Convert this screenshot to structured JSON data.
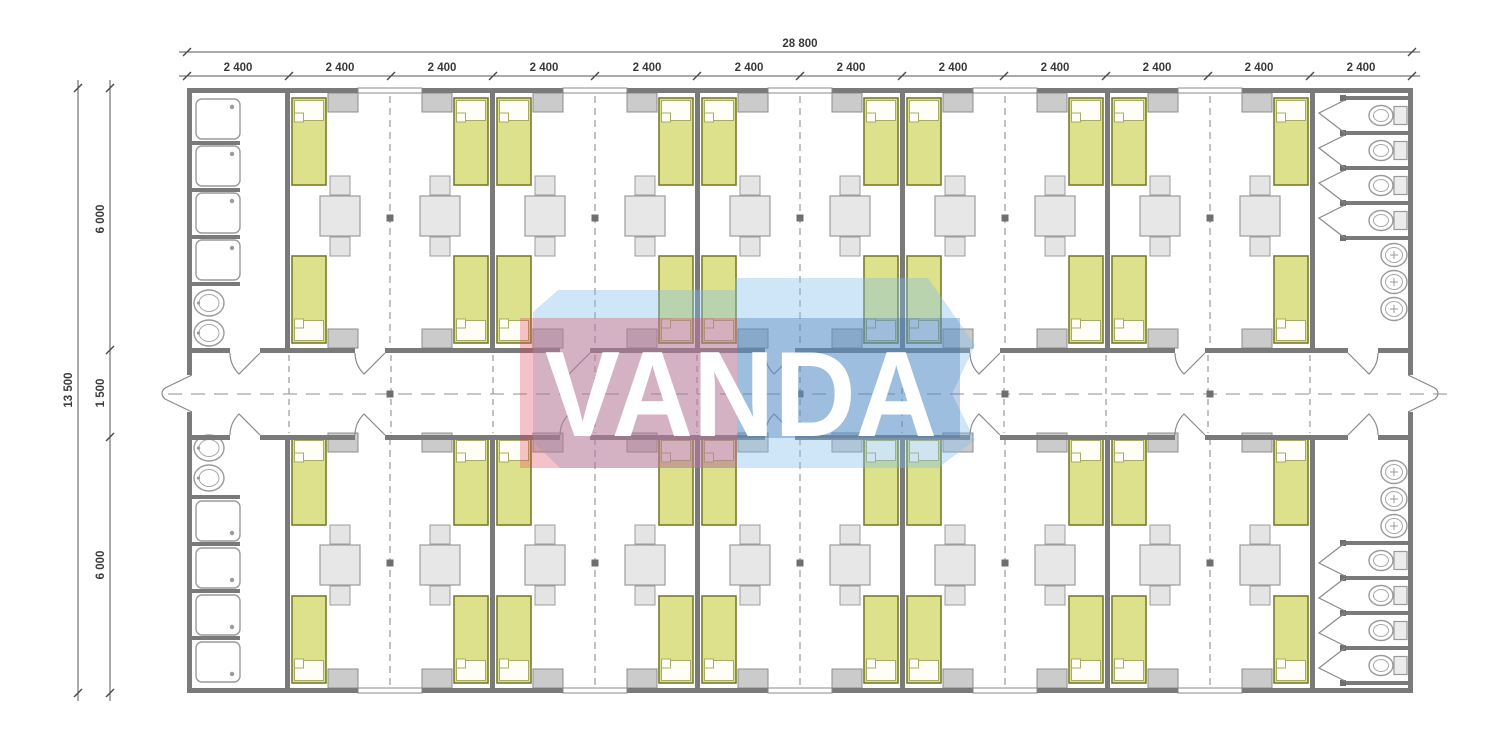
{
  "page": {
    "background": "#ffffff",
    "drawing_type": "modular dormitory floor plan"
  },
  "watermark": {
    "text": "VANDA",
    "colors": {
      "pink": "#e4465a",
      "blue": "#3c6eaf",
      "light_blue": "#7dbeeb",
      "text": "#ffffff"
    }
  },
  "dimensions": {
    "top_total": "28 800",
    "top_segments": [
      "2 400",
      "2 400",
      "2 400",
      "2 400",
      "2 400",
      "2 400",
      "2 400",
      "2 400",
      "2 400",
      "2 400",
      "2 400",
      "2 400"
    ],
    "left_total": "13 500",
    "left_segments": [
      "6 000",
      "1 500",
      "6 000"
    ]
  },
  "plan": {
    "rooms": 10,
    "beds": 40,
    "tables": 20,
    "fixtures": {
      "showers": 8,
      "washbasins": 4,
      "toilets": 8,
      "urinals": 6
    },
    "colors": {
      "bed_fill": "#dde18c",
      "bed_border": "#787c2c",
      "furniture_fill": "#e4e4e4",
      "cabinet_fill": "#cbcbcb",
      "wall": "#7a7a7a"
    }
  }
}
